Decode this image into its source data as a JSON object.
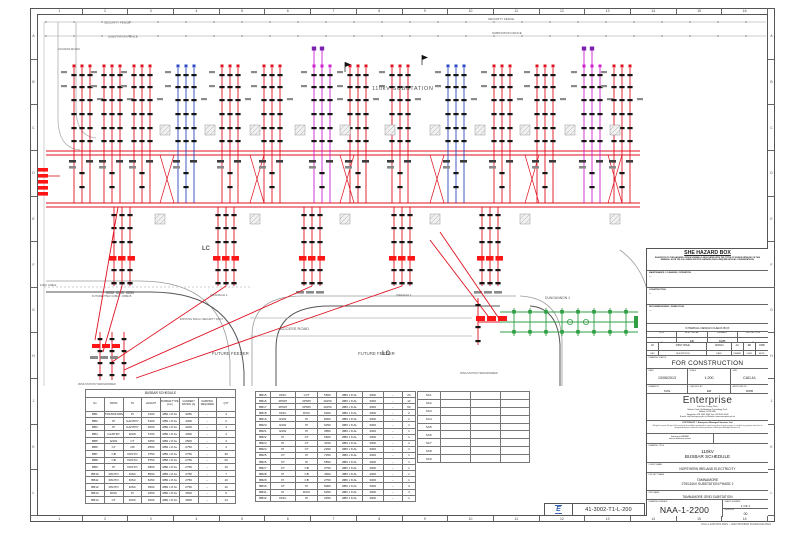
{
  "border": {
    "grid_cols": [
      "1",
      "2",
      "3",
      "4",
      "5",
      "6",
      "7",
      "8",
      "9",
      "10",
      "11",
      "12",
      "13",
      "14",
      "15",
      "16"
    ],
    "grid_rows": [
      "A",
      "B",
      "C",
      "D",
      "E",
      "F",
      "G",
      "H",
      "J",
      "K",
      "L"
    ]
  },
  "colors": {
    "busbar_red": "#e0101f",
    "bay_blue": "#2b46c0",
    "bay_magenta": "#cf1fcf",
    "bay_purple": "#7a1fae",
    "existing_green": "#2f9e44",
    "highlight_red": "#ff1515",
    "stamp_blue": "#3a66b8",
    "equipment_black": "#141414",
    "road_grey": "#8f8f8f"
  },
  "icons": {
    "stamp_logo": "enterprise-logo-icon"
  },
  "drawing": {
    "labels": {
      "substation": "110kV SUBSTATION",
      "security_fence": "SECURITY FENCE",
      "substation_fence": "SUBSTATION FENCE",
      "access_road": "ACCESS ROAD",
      "future_feeder": "FUTURE FEEDER",
      "cable_110": "110kV CABLE",
      "future_cable": "FUTURE 275kV CABLE - WIRE B",
      "duct": "EXISTING 500mm SECURITY DUCT",
      "dungannon": "DUNGANNON 1",
      "cranagh": "CRANAGH 1",
      "creagh": "CREAGH 1",
      "station_tx": "2MVA STATION TRANSFORMER",
      "lc": "LC"
    }
  },
  "schedule": {
    "title": "BUSBAR SCHEDULE",
    "headers": [
      "No",
      "FROM",
      "TO",
      "LENGTH",
      "BUSBAR TYPE (mm)",
      "CURRENT RATING (A)",
      "DAMPING REQUIRED",
      "QTY"
    ],
    "rows1": [
      [
        "BB1",
        "TRANSFORMER",
        "PI",
        "3100",
        "Ø80 x 8 AL",
        "3250",
        "–",
        "4"
      ],
      [
        "BB2",
        "PI",
        "GANTRY",
        "5100",
        "Ø80 x 8 AL",
        "4300",
        "–",
        "2"
      ],
      [
        "BB3",
        "PI",
        "GANTRY",
        "4000",
        "Ø80 x 8 AL",
        "4200",
        "–",
        "4"
      ],
      [
        "BB4",
        "GANTRY",
        "ESW",
        "5700",
        "Ø80 x 8 AL",
        "4300",
        "–",
        "4"
      ],
      [
        "BB5",
        "ESW",
        "CT",
        "3250",
        "Ø80 x 8 AL",
        "2500",
        "–",
        "4"
      ],
      [
        "BB6",
        "CT",
        "CB",
        "2500",
        "Ø80 x 8 AL",
        "2750",
        "–",
        "4"
      ],
      [
        "BB7",
        "CB",
        "PANTO",
        "3750",
        "Ø80 x 8 AL",
        "2750",
        "–",
        "30"
      ],
      [
        "BB8",
        "CB",
        "PANTO",
        "5750",
        "Ø80 x 8 AL",
        "2750",
        "–",
        "20"
      ],
      [
        "BB9",
        "PI",
        "PANTO",
        "4800",
        "Ø80 x 8 AL",
        "2750",
        "–",
        "10"
      ],
      [
        "BB10",
        "PANTO",
        "DISC",
        "8500",
        "Ø80 x 8 AL",
        "2750",
        "–",
        "7"
      ],
      [
        "BB11",
        "PANTO",
        "DISC",
        "6250",
        "Ø80 x 8 AL",
        "2750",
        "–",
        "10"
      ],
      [
        "BB12",
        "PANTO",
        "DISC",
        "3500",
        "Ø80 x 8 AL",
        "2750",
        "–",
        "10"
      ],
      [
        "BB13",
        "DISC",
        "PI",
        "3250",
        "Ø80 x 8 AL",
        "3500",
        "–",
        "9"
      ],
      [
        "BB14",
        "CT",
        "DISC",
        "2500",
        "Ø80 x 8 AL",
        "3500",
        "–",
        "14"
      ]
    ],
    "rows2": [
      [
        "BB15",
        "DISC",
        "CVT",
        "5500",
        "Ø80 x 8 AL",
        "3300",
        "–",
        "24"
      ],
      [
        "BB16",
        "2PNPI",
        "2PNPI",
        "10150",
        "Ø80 x 8 AL",
        "3300",
        "–",
        "12"
      ],
      [
        "BB17",
        "2PNPI",
        "2PNPI",
        "10150",
        "Ø80 x 8 AL",
        "3300",
        "–",
        "60"
      ],
      [
        "BB18",
        "DISC",
        "DISC",
        "6200",
        "Ø80 x 8 AL",
        "3300",
        "–",
        "2"
      ],
      [
        "BB19",
        "ESW",
        "PI",
        "8000",
        "Ø80 x 8 AL",
        "3300",
        "–",
        "1"
      ],
      [
        "BB20",
        "ESW",
        "PI",
        "6250",
        "Ø80 x 8 AL",
        "3300",
        "–",
        "1"
      ],
      [
        "BB21",
        "ESW",
        "PI",
        "3850",
        "Ø80 x 8 AL",
        "3300",
        "–",
        "1"
      ],
      [
        "BB22",
        "PI",
        "CT",
        "6500",
        "Ø80 x 8 AL",
        "3300",
        "–",
        "1"
      ],
      [
        "BB23",
        "PI",
        "CT",
        "4150",
        "Ø80 x 8 AL",
        "3300",
        "–",
        "1"
      ],
      [
        "BB24",
        "PI",
        "CT",
        "2250",
        "Ø80 x 8 AL",
        "3300",
        "–",
        "1"
      ],
      [
        "BB25",
        "CT",
        "PI",
        "7250",
        "Ø80 x 8 AL",
        "3300",
        "–",
        "1"
      ],
      [
        "BB26",
        "CT",
        "PI",
        "5550",
        "Ø80 x 8 AL",
        "3300",
        "–",
        "1"
      ],
      [
        "BB27",
        "CT",
        "CB",
        "3750",
        "Ø80 x 8 AL",
        "3300",
        "–",
        "1"
      ],
      [
        "BB28",
        "PI",
        "CB",
        "4500",
        "Ø80 x 8 AL",
        "3300",
        "–",
        "1"
      ],
      [
        "BB29",
        "PI",
        "CB",
        "2750",
        "Ø80 x 8 AL",
        "3300",
        "–",
        "1"
      ],
      [
        "BB30",
        "CT",
        "PI",
        "8000",
        "Ø80 x 8 AL",
        "3300",
        "–",
        "3"
      ],
      [
        "BB31",
        "PI",
        "DISC",
        "6250",
        "Ø80 x 8 AL",
        "3300",
        "–",
        "3"
      ],
      [
        "BB32",
        "DISC",
        "PI",
        "3250",
        "Ø80 x 8 AL",
        "3300",
        "–",
        "1"
      ]
    ],
    "sc_rows": [
      "SC1",
      "SC2",
      "SC3",
      "SC4",
      "SC5",
      "SC6",
      "SC7",
      "SC8",
      "SC9"
    ]
  },
  "titleblock": {
    "she": {
      "title": "SHE HAZARD BOX",
      "body": "IN ADDITION TO THE HAZARDS / RISKS NORMALLY ASSOCIATED WITH THE TYPES OF WORKS DETAILED ON THIS DRAWING, NOTE THE FOLLOWING SPECIFIC HAZARDS WHICH REQUIRE SPECIAL CONSIDERATIONS.",
      "sections": [
        {
          "label": "MAINTENANCE / CLEANING / OPERATION",
          "value": "---"
        },
        {
          "label": "CONSTRUCTION",
          "value": "---"
        },
        {
          "label": "DECOMMISSIONING / DEMOLITION",
          "value": "---"
        }
      ]
    },
    "check_box": {
      "title": "INTERNAL DESIGN CHECK BOX",
      "cols": [
        "CIVIL",
        "ELECTRICAL",
        "PRIMARY",
        "PROTECTION"
      ],
      "vals": [
        "--",
        "EB",
        "DWB",
        "--"
      ]
    },
    "revision": {
      "row": [
        "0A",
        "FIRST ISSUE",
        "13/06/13",
        "AA",
        "EB",
        "DWB"
      ],
      "headers": [
        "REV",
        "DESCRIPTION",
        "DATE",
        "DRAWN",
        "CHKD",
        "APPD"
      ]
    },
    "status_label": "DRAWING STATUS",
    "status": "FOR CONSTRUCTION",
    "meta": {
      "date_label": "DATE",
      "date": "13/06/2013",
      "scale_label": "SCALE",
      "scale": "1:200",
      "size_label": "SIZE",
      "size": "CAD A1",
      "drawn_label": "DRAWN BY",
      "drawn": "SJW",
      "checked_label": "CHECKED BY",
      "checked": "EB",
      "approved_label": "APPROVED BY",
      "approved": "DWB"
    },
    "company": {
      "name": "Enterprise",
      "address1": "3rd Floor, Victory Plant,",
      "address2": "Nelson Court, Staffordshire Technology Park,",
      "address3": "Belfast, BT99 9MD",
      "phone": "Telephone: 028 9045 4545    Fax: 028 9045 4546",
      "contact": "E-mail: info@enterprise.plc.uk    Website: www.enterprise.plc.uk"
    },
    "copyright": {
      "line1": "COPYRIGHT © Enterprise Managed Services Ltd.",
      "body": "All rights reserved. No part of this work may be modified, reproduced or copied in any form or by any means, or used for any purpose other than its designated purpose, without the written permission of Enterprise Managed Services Ltd."
    },
    "note": {
      "line1": "Drawing to BS8888",
      "line2": "unless otherwise stated"
    },
    "title_label": "DRAWING TITLE",
    "title_line1": "110kV",
    "title_line2": "BUSBAR SCHEDULE",
    "client_label": "CLIENT NAME",
    "client": "NORTHERN IRELAND ELECTRICITY",
    "project_label": "PROJECT NAME",
    "project_line1": "TAMNAMORE",
    "project_line2": "275/110kV SUBSTATION PHASE 2",
    "site_label": "SITE NAME",
    "site": "TAMNAMORE GRID SUBSTATION",
    "number_label": "DRAWING NUMBER",
    "number": "NAA-1-2200",
    "sheet_label": "SHEET NUMBER",
    "sheet": "1 OF 1",
    "rev_label": "REVISION",
    "rev": "00",
    "filename": "NAA-1-2200 R00.DWG  -  110kV BUSBAR SCHEDULE.DWG"
  },
  "stamp": {
    "number": "41-3002-T1-L-200",
    "logo_text": "E"
  }
}
